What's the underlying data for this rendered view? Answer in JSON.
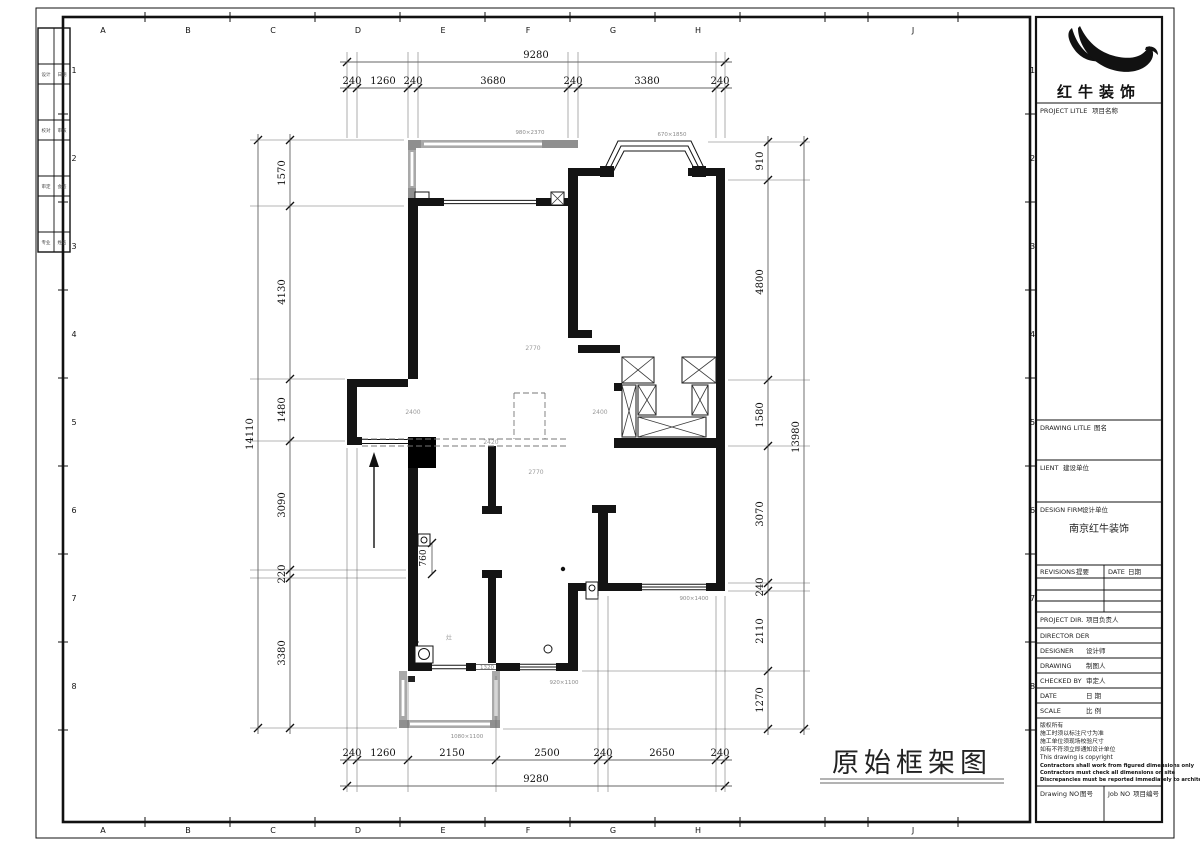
{
  "main_title": "原始框架图",
  "sheet": {
    "col_letters": [
      "A",
      "B",
      "C",
      "D",
      "E",
      "F",
      "G",
      "H",
      "J"
    ],
    "row_numbers": [
      "1",
      "2",
      "3",
      "4",
      "5",
      "6",
      "7",
      "8"
    ],
    "signoff_cells": [
      "设计",
      "日期",
      "校对",
      "审核",
      "审定",
      "会签",
      "专业",
      "姓名"
    ]
  },
  "plan": {
    "dims": {
      "top_total": "9280",
      "top_segments": [
        "240",
        "1260",
        "240",
        "3680",
        "240",
        "3380",
        "240"
      ],
      "bottom_segments": [
        "240",
        "1260",
        "2150",
        "2500",
        "240",
        "2650",
        "240"
      ],
      "bottom_total": "9280",
      "left_total": "14110",
      "left_segments": [
        "1570",
        "4130",
        "1480",
        "3090",
        "220",
        "3380"
      ],
      "right_segments": [
        "910",
        "4800",
        "1580",
        "3070",
        "240",
        "2110",
        "1270"
      ],
      "right_total": "13980",
      "door_dim": "760"
    },
    "window_labels": {
      "balcony_top": "980×2370",
      "bay": "670×1850",
      "bedroom3": "900×1400",
      "hall": "920×1100",
      "balcony_bottom": "1080×1100",
      "kitchen_door": "1320"
    },
    "room_dim_labels": {
      "living_top": "2770",
      "entry": "2400",
      "corridor": "2400",
      "beam": "2420",
      "living_bottom": "2770"
    },
    "kitchen_mark": "灶"
  },
  "title_block": {
    "brand": "红牛装饰",
    "project_title_en": "PROJECT LITLE",
    "project_title_cn": "项目名称",
    "drawing_title_en": "DRAWING LITLE",
    "drawing_title_cn": "图名",
    "client_en": "LIENT",
    "client_cn": "建设单位",
    "design_firm_en": "DESIGN FIRM",
    "design_firm_cn": "设计单位",
    "design_firm_name": "南京红牛装饰",
    "revisions_en": "REVISIONS",
    "revisions_cn": "提要",
    "date_col_en": "DATE",
    "date_col_cn": "日期",
    "staff": [
      {
        "en": "PROJECT DIR.",
        "cn": "项目负责人"
      },
      {
        "en": "DIRECTOR DER",
        "cn": ""
      },
      {
        "en": "DESIGNER",
        "cn": "设计师"
      },
      {
        "en": "DRAWING",
        "cn": "制图人"
      },
      {
        "en": "CHECKED BY",
        "cn": "审定人"
      },
      {
        "en": "DATE",
        "cn": "日  期"
      },
      {
        "en": "SCALE",
        "cn": "比  例"
      }
    ],
    "copyright": [
      "版权所有",
      "施工时须以标注尺寸为准",
      "施工单位须现场校验尺寸",
      "如有不符须立即通知设计单位",
      "This drawing is copyright",
      "Contractors shall work from figured dimensions only",
      "Contractors must check all dimensions on site",
      "Discrepancies must be reported immediately to architect"
    ],
    "drawing_no_en": "Drawing NO",
    "drawing_no_cn": "图号",
    "job_no_en": "Job NO",
    "job_no_cn": "项目编号"
  }
}
